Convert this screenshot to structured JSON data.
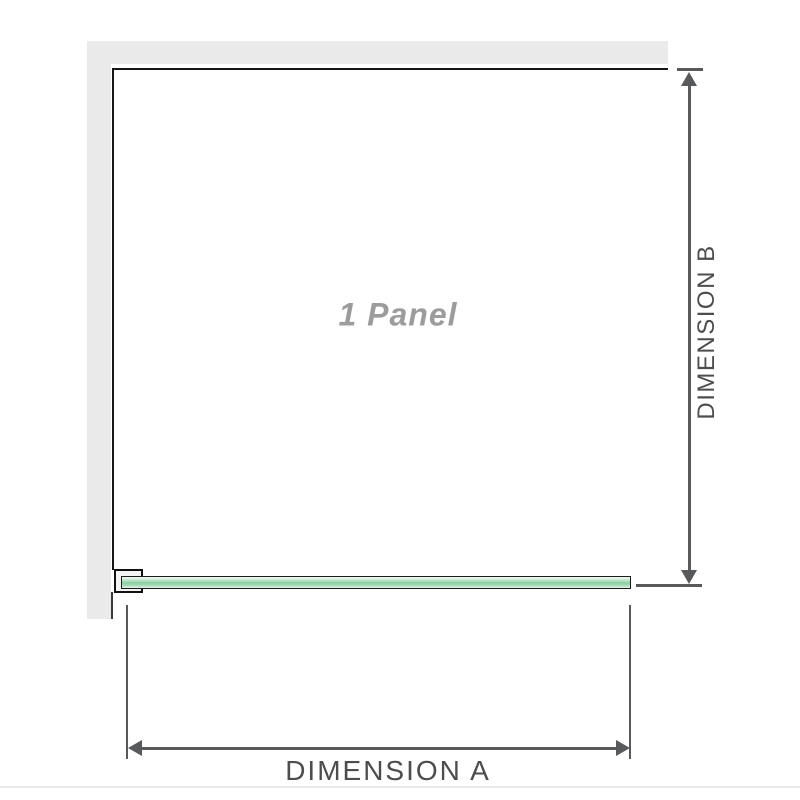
{
  "diagram": {
    "panel_label": "1 Panel",
    "dimensions": {
      "a_label": "DIMENSION A",
      "b_label": "DIMENSION B"
    },
    "colors": {
      "wall_fill": "#eaeaea",
      "panel_outline": "#151515",
      "dimension_lines": "#58595b",
      "dimension_text": "#4d4d4d",
      "glass_green_mid": "#8fd0a5",
      "glass_green_light": "#dcf0e4",
      "panel_label_gray": "#9c9c9c"
    }
  }
}
